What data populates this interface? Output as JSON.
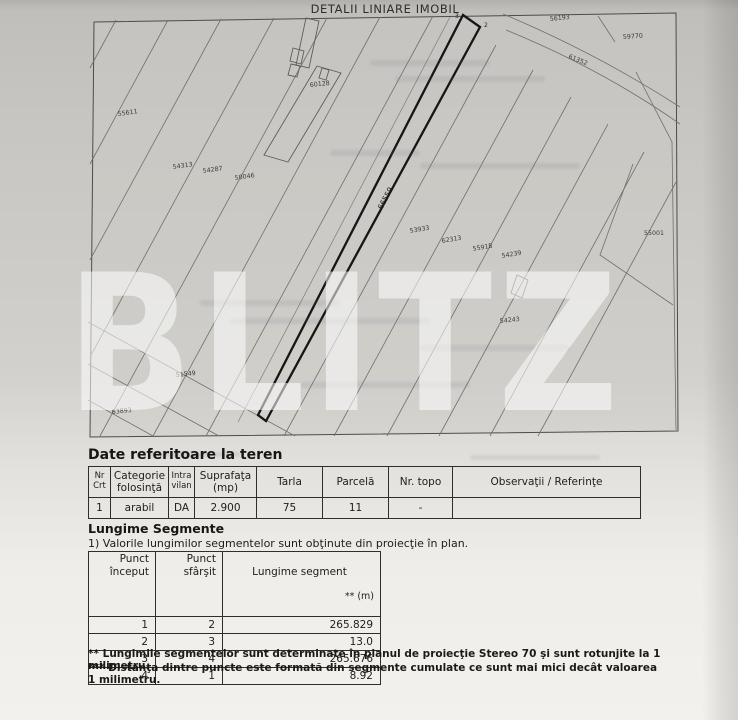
{
  "title": "DETALII LINIARE IMOBIL",
  "watermark": "BLITZ",
  "map": {
    "labels": {
      "f1": "55611",
      "f2": "54313",
      "f3": "54287",
      "f4": "50046",
      "f5": "60128",
      "f6": "66559",
      "f7": "53933",
      "f8": "62313",
      "f9": "55918",
      "f10": "54239",
      "f11": "54243",
      "f12": "55001",
      "f13": "56193",
      "f14": "59770",
      "f15": "61352",
      "f16": "51549",
      "f17": "63893"
    },
    "vertices": {
      "v2": "2",
      "v3": "3"
    }
  },
  "land_table": {
    "heading": "Date referitoare la teren",
    "columns": [
      "Nr\nCrt",
      "Categorie\nfolosinţă",
      "Intra\nvilan",
      "Suprafaţa\n(mp)",
      "Tarla",
      "Parcelă",
      "Nr. topo",
      "Observaţii / Referinţe"
    ],
    "row": [
      "1",
      "arabil",
      "DA",
      "2.900",
      "75",
      "11",
      "-",
      ""
    ]
  },
  "segments": {
    "heading": "Lungime Segmente",
    "note": "1) Valorile lungimilor segmentelor sunt obţinute din proiecţie în plan.",
    "columns": [
      "Punct\nînceput",
      "Punct\nsfârşit"
    ],
    "len_header": {
      "line1": "Lungime segment",
      "line2": "** (m)"
    },
    "rows": [
      [
        "1",
        "2",
        "265.829"
      ],
      [
        "2",
        "3",
        "13.0"
      ],
      [
        "3",
        "4",
        "265.676"
      ],
      [
        "4",
        "1",
        "8.92"
      ]
    ],
    "footnotes": [
      "** Lungimile segmentelor sunt determinate în planul de proiecţie Stereo 70 şi sunt rotunjite la 1 milimetru.",
      "*** Distanţa dintre puncte este formată din segmente cumulate ce sunt mai mici decât valoarea 1 milimetru."
    ]
  }
}
